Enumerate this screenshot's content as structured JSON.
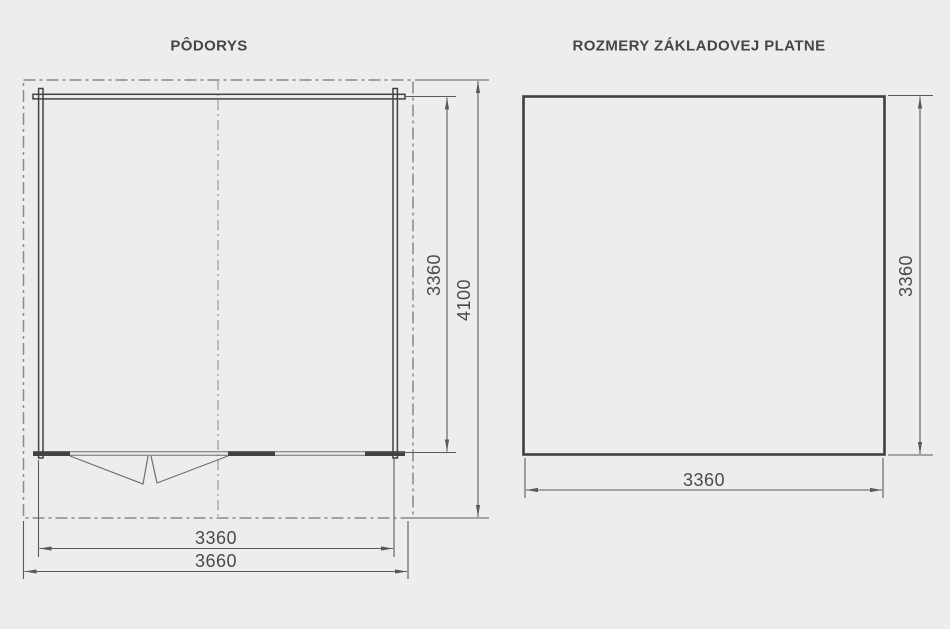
{
  "page": {
    "background_color": "#ededed",
    "line_color_walls": "#424242",
    "line_color_dims": "#5a5a5a",
    "line_color_outline": "#8a8a8a"
  },
  "left_panel": {
    "title": "PÔDORYS",
    "dims": {
      "inner_height": "3360",
      "outer_height": "4100",
      "inner_width": "3360",
      "outer_width": "3660"
    }
  },
  "right_panel": {
    "title": "ROZMERY ZÁKLADOVEJ PLATNE",
    "dims": {
      "height": "3360",
      "width": "3360"
    }
  }
}
